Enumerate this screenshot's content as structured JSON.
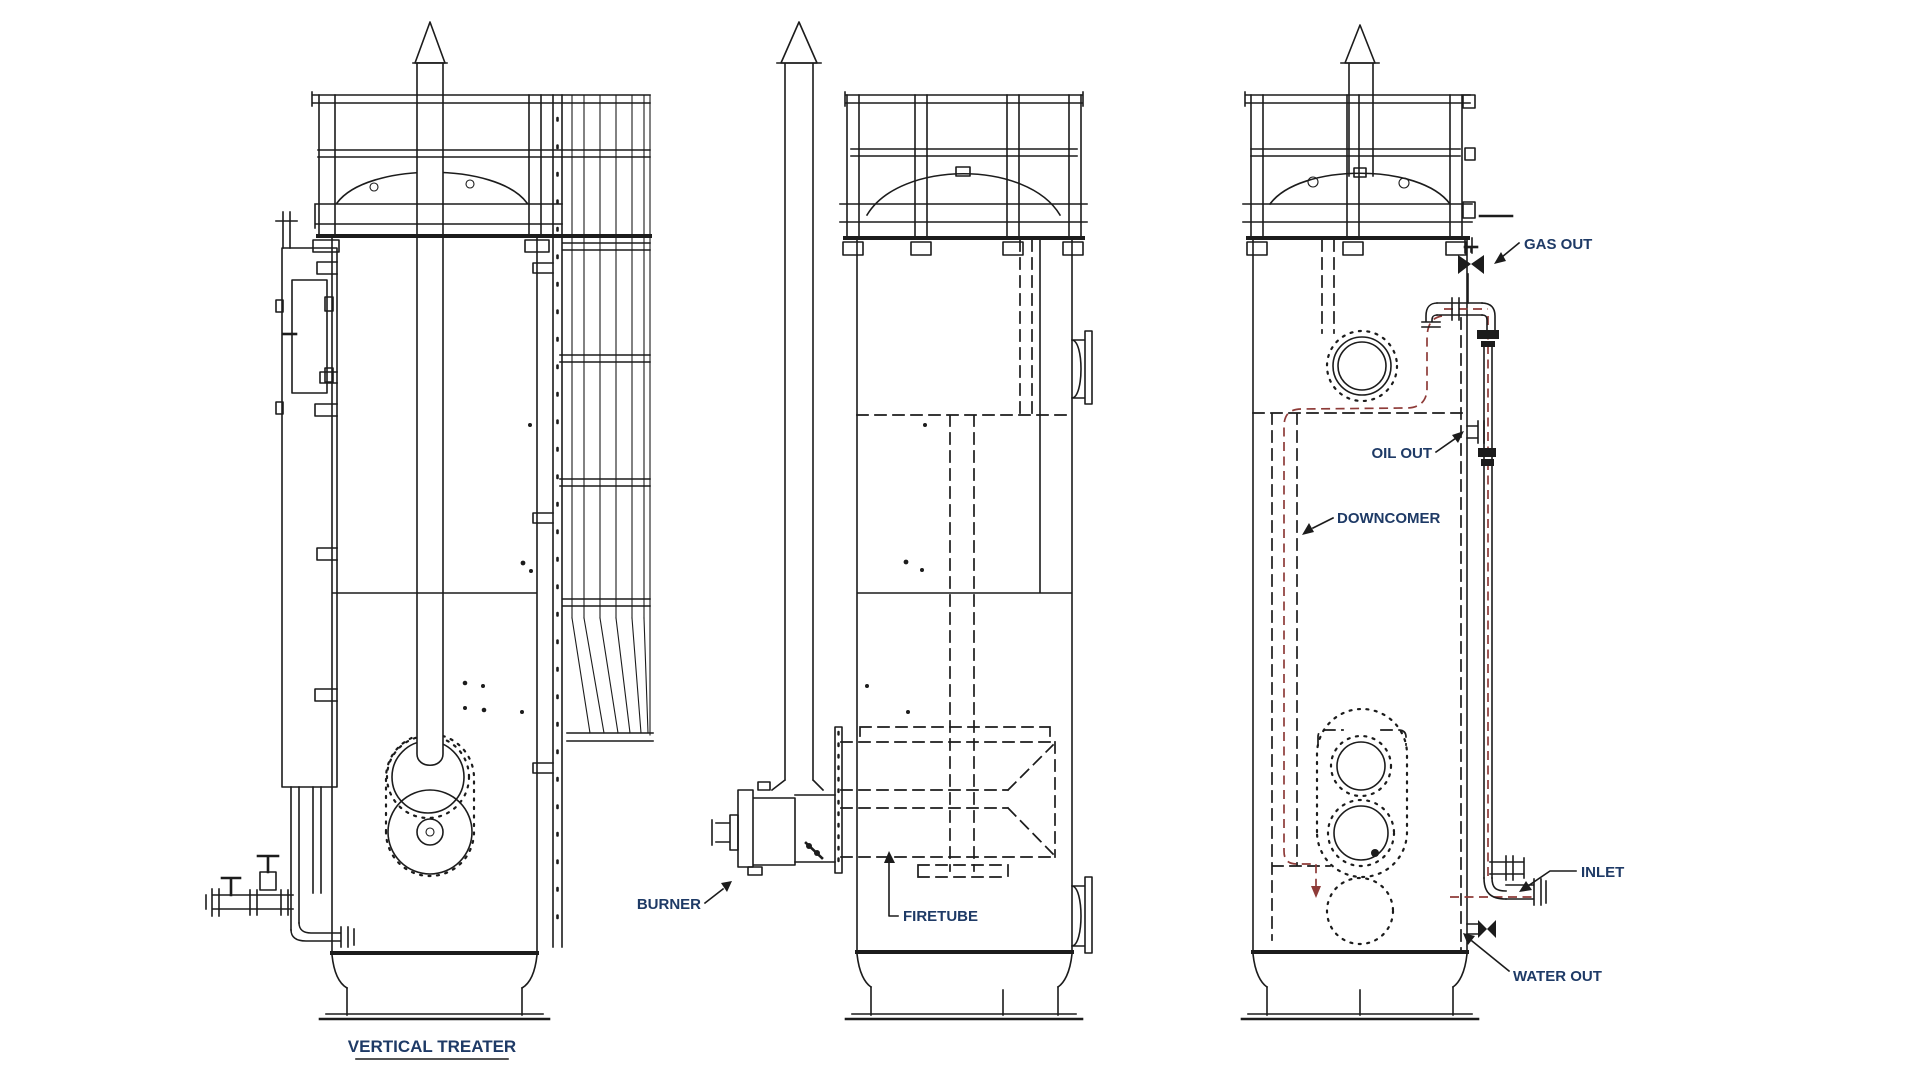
{
  "drawing": {
    "title": "VERTICAL TREATER",
    "labels": {
      "burner": "BURNER",
      "firetube": "FIRETUBE",
      "gas_out": "GAS OUT",
      "oil_out": "OIL OUT",
      "downcomer": "DOWNCOMER",
      "inlet": "INLET",
      "water_out": "WATER OUT"
    },
    "colors": {
      "line": "#1c1c1c",
      "flow_red": "#8e3b38",
      "label_text": "#1e3a66",
      "background": "#ffffff"
    }
  }
}
